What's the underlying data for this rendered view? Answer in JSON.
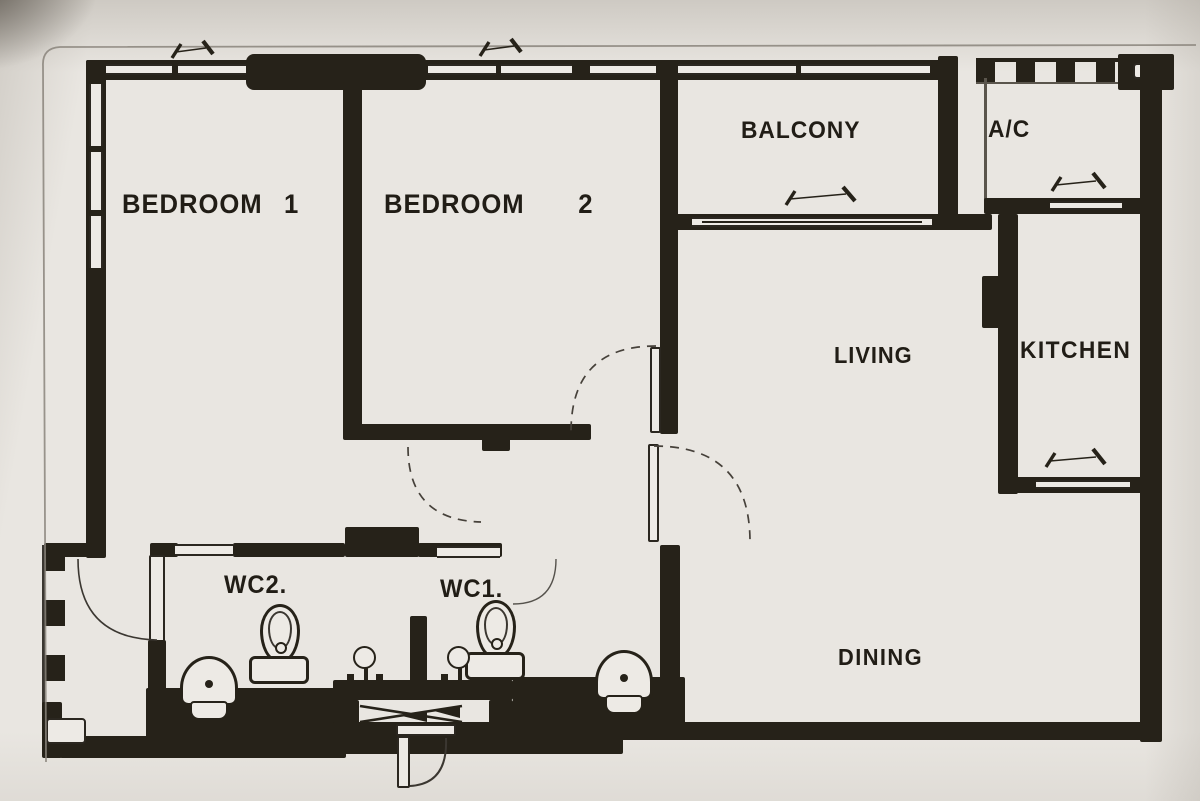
{
  "figure": {
    "type": "apartment-floor-plan",
    "style": "scanned-blackline-drawing"
  },
  "rooms": {
    "bedroom1": {
      "label": "BEDROOM 1"
    },
    "bedroom2": {
      "label": "BEDROOM 2"
    },
    "balcony": {
      "label": "BALCONY"
    },
    "ac": {
      "label": "A/C"
    },
    "living": {
      "label": "LIVING"
    },
    "kitchen": {
      "label": "KITCHEN"
    },
    "wc2": {
      "label": "WC2."
    },
    "wc1": {
      "label": "WC1."
    },
    "dining": {
      "label": "DINING"
    }
  },
  "fixtures": {
    "wc2": [
      "toilet",
      "wash-basin",
      "shower-mixer"
    ],
    "wc1": [
      "toilet",
      "wash-basin",
      "shower-mixer"
    ]
  },
  "annotations": {
    "swing_arrows": [
      "top-wall-left",
      "top-wall-mid",
      "balcony-sliding-door",
      "ac-access",
      "kitchen-door"
    ],
    "door_arcs": [
      "service-door",
      "wc1-door",
      "bedroom2-door",
      "hall-living-door",
      "hall-dining-door",
      "entrance-outer-door"
    ],
    "entrance": "double-swing-door"
  },
  "colors": {
    "paper": "#e9e6e1",
    "ink": "#262219",
    "pencil": "#46413a",
    "scan_border": "#8a847b"
  }
}
